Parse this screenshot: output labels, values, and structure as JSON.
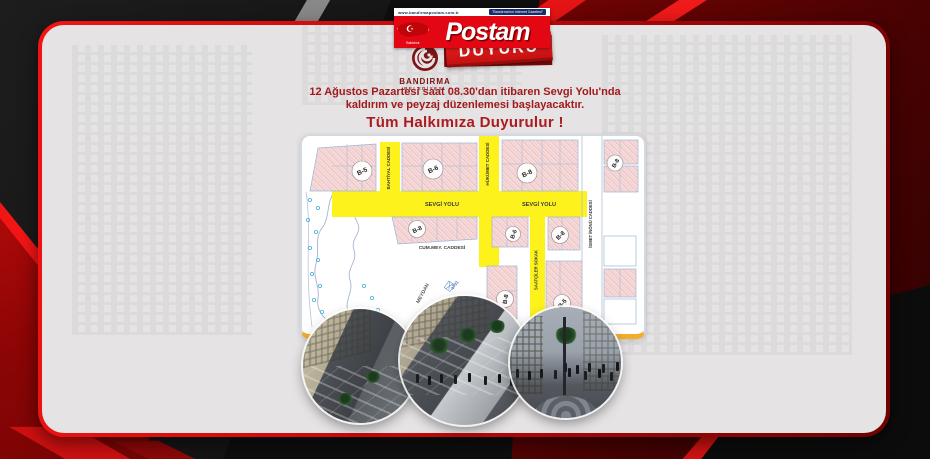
{
  "masthead": {
    "site_url": "www.bandirmapostam.com.tr",
    "slogan": "\"Bandırma'nın İnternet Gazetesi\"",
    "logo_text": "Postam",
    "region": "Balıkesir",
    "banner_label": "DUYURU",
    "municipality": {
      "name": "BANDIRMA",
      "sub": "BELEDİYESİ"
    }
  },
  "announcement": {
    "line1": "12 Ağustos Pazartesi saat 08.30'dan itibaren Sevgi Yolu'nda",
    "line2": "kaldırım ve peyzaj düzenlemesi başlayacaktır.",
    "headline": "Tüm Halkımıza Duyurulur !"
  },
  "map": {
    "streets": {
      "bahtiyal": "BAHTİYAL CADDESİ",
      "hukumet": "HÜKÜMET CADDESİ",
      "sevgi_left": "SEVGİ YOLU",
      "sevgi_right": "SEVGİ YOLU",
      "ismet_inonu": "İSMET İNÖNÜ CADDESİ",
      "cum_mey": "CUM.MEY. CADDESİ",
      "saatciler": "SAATÇİLER SOKAK",
      "meydan": "MEYDAN"
    },
    "note": "4731",
    "blocks": [
      {
        "label": "B-5"
      },
      {
        "label": "B-6"
      },
      {
        "label": "B-8"
      },
      {
        "label": "B-8"
      },
      {
        "label": "B-8"
      },
      {
        "label": "B-6"
      },
      {
        "label": "B-8"
      },
      {
        "label": "B-8"
      },
      {
        "label": "B-5"
      }
    ],
    "renders": [
      "street-render-aerial-left",
      "street-render-aerial-center",
      "street-render-ground-right"
    ]
  },
  "colors": {
    "brand_red": "#e30613",
    "ribbon_red": "#c01010",
    "announcement_red": "#a21a1d",
    "road_yellow": "#fdf21b",
    "block_pink": "#f6dcdc",
    "panel_gold": "#f2ae2a",
    "card_gray": "#e5e3e4"
  }
}
